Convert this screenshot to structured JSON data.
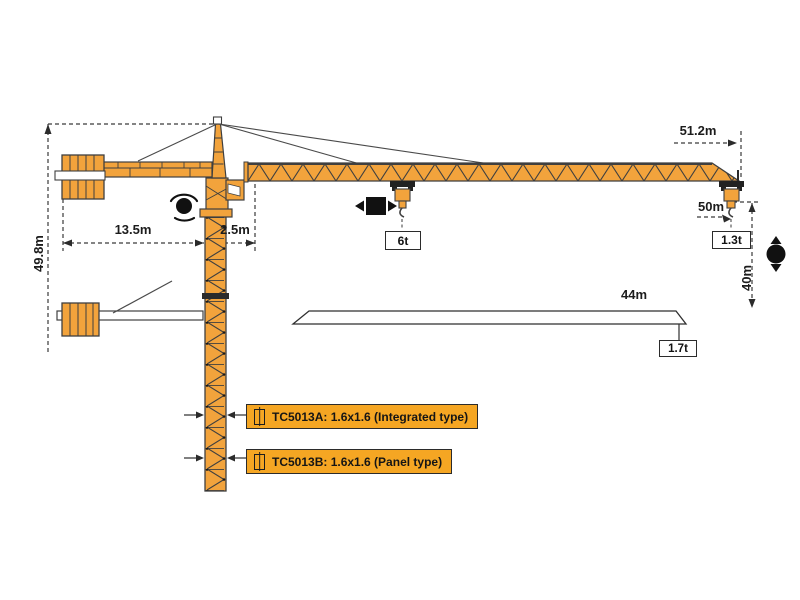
{
  "colors": {
    "crane_orange": "#F2A33C",
    "label_bg": "#F5A623",
    "line": "#3a3a3a"
  },
  "dimensions": {
    "tower_height": "49.8m",
    "counter_jib_radius": "13.5m",
    "slew_offset": "2.5m",
    "jib_radius": "51.2m",
    "hook_radius": "50m",
    "lift_height": "40m",
    "mid_span": "44m"
  },
  "loads": {
    "max_load": "6t",
    "tip_load": "1.3t",
    "mid_span_load": "1.7t"
  },
  "models": [
    {
      "label": "TC5013A:  1.6x1.6  (Integrated type)"
    },
    {
      "label": "TC5013B:  1.6x1.6  (Panel type)"
    }
  ],
  "icons": {
    "slew": "rotation-symbol",
    "trolley_travel": "left-right-arrows",
    "hoist": "up-down-arrows",
    "mast_section": "square-with-vertical-bar"
  }
}
